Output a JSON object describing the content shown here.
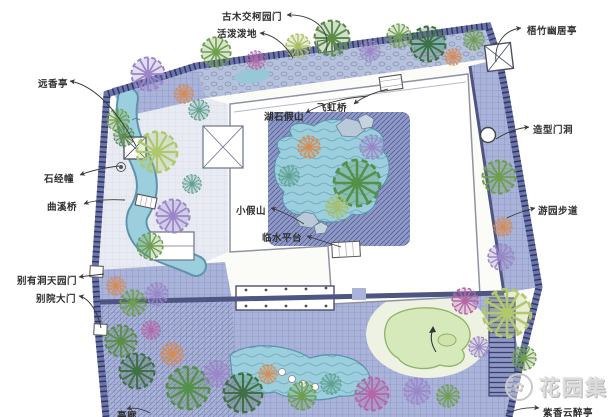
{
  "plan": {
    "type": "garden-landscape-plan",
    "labels": [
      {
        "text": "古木交柯园门"
      },
      {
        "text": "活泼泼地"
      },
      {
        "text": "梧竹幽居亭"
      },
      {
        "text": "远香亭"
      },
      {
        "text": "湖石假山"
      },
      {
        "text": "飞虹桥"
      },
      {
        "text": "造型门洞"
      },
      {
        "text": "石经幢"
      },
      {
        "text": "曲溪桥"
      },
      {
        "text": "游园步道"
      },
      {
        "text": "小假山"
      },
      {
        "text": "临水平台"
      },
      {
        "text": "别有洞天园门"
      },
      {
        "text": "别院大门"
      },
      {
        "text": "亭廊"
      },
      {
        "text": "紫香云醉亭"
      }
    ]
  },
  "watermark": {
    "logo_icon": "flower-icon",
    "text": "花园集"
  },
  "colors": {
    "paving_lavender": "#aab3d9",
    "paving_ring": "#8e99c9",
    "wall_dark": "#4d5583",
    "wall_light": "#6a74a8",
    "water_teal": "#9ccfdd",
    "water_edge": "#5d94ab",
    "pond_green": "#d6e9ba",
    "lawn": "#eef2e3",
    "rock_blue": "#b9c9d9",
    "tree_green": "#6f9e4f",
    "tree_dark_green": "#3f7046",
    "tree_purple": "#9a86c8",
    "tree_magenta": "#b566a8",
    "tree_orange": "#d98a4f",
    "tree_yellow_green": "#b3c86d",
    "tree_teal": "#5fa08e",
    "label_text": "#2f2f2f",
    "watermark_gray": "#c9c9c9"
  }
}
